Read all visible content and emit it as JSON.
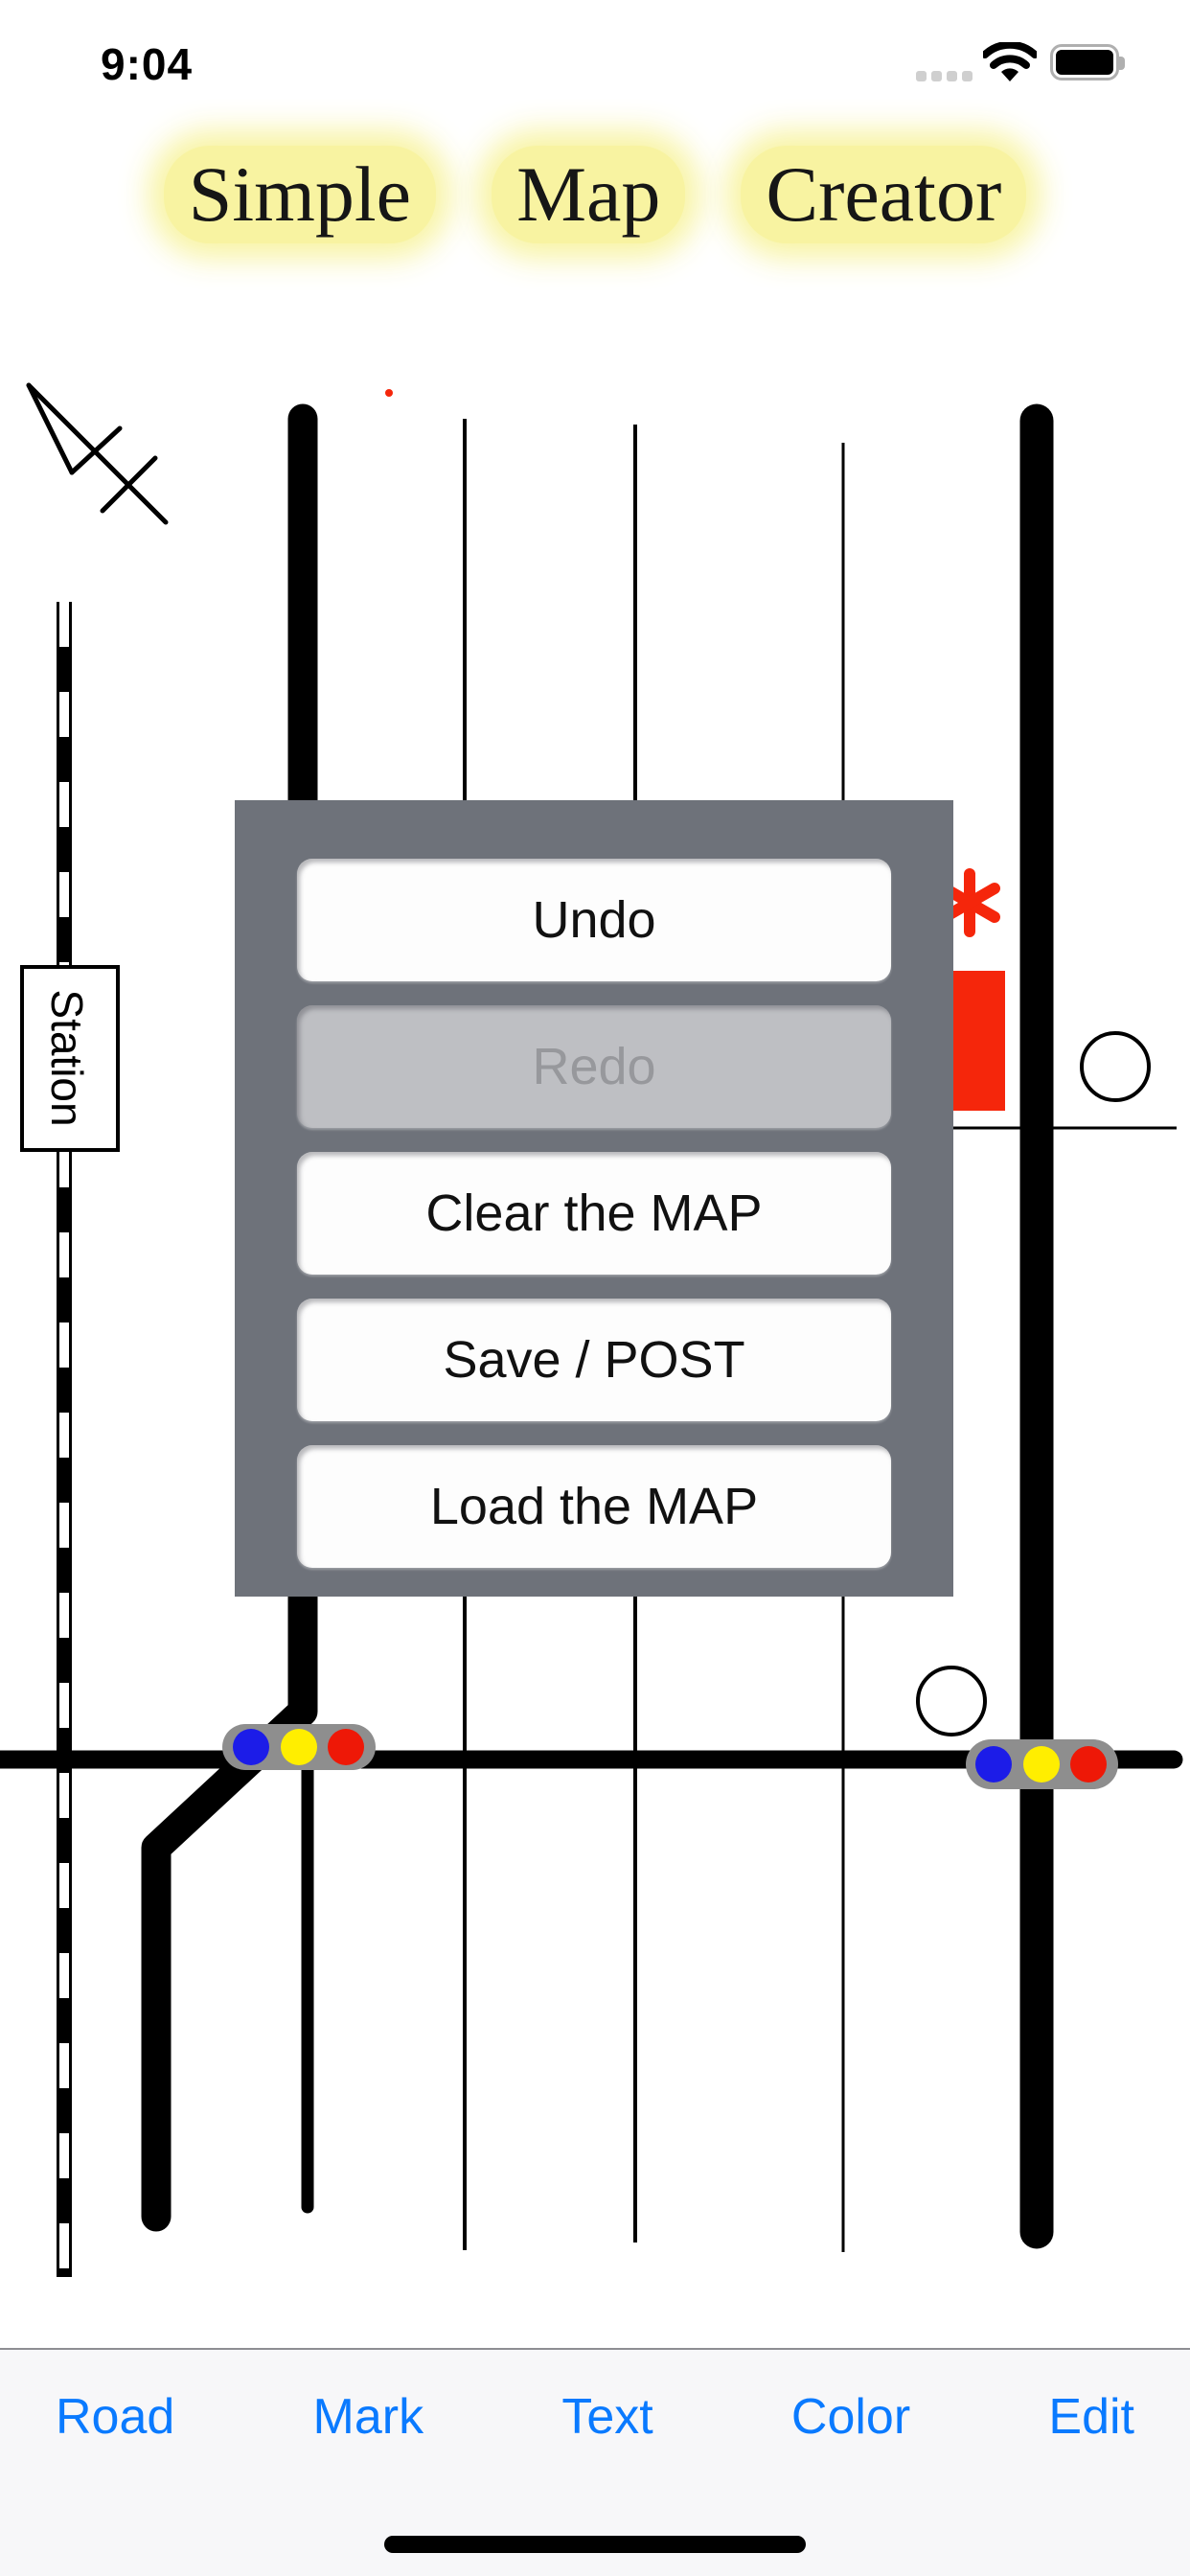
{
  "status_bar": {
    "time": "9:04",
    "battery_level": "full",
    "wifi": "connected"
  },
  "title": {
    "words": [
      "Simple",
      "Map",
      "Creator"
    ]
  },
  "map": {
    "station_label": "Station"
  },
  "popup": {
    "buttons": [
      {
        "label": "Undo",
        "enabled": true
      },
      {
        "label": "Redo",
        "enabled": false
      },
      {
        "label": "Clear the MAP",
        "enabled": true
      },
      {
        "label": "Save / POST",
        "enabled": true
      },
      {
        "label": "Load the MAP",
        "enabled": true
      }
    ]
  },
  "toolbar": {
    "items": [
      "Road",
      "Mark",
      "Text",
      "Color",
      "Edit"
    ]
  },
  "colors": {
    "ink": "#000000",
    "paper": "#ffffff",
    "popup_bg": "#6E727A",
    "button_bg": "#FDFDFD",
    "button_text": "#111111",
    "disabled_bg": "#BEBFC3",
    "disabled_text": "#97989C",
    "toolbar_bg": "#F7F7F9",
    "toolbar_border": "#8E8E93",
    "accent_blue": "#0A7AFF",
    "highlight_yellow": "#F8F3A1",
    "red": "#F5260B",
    "traffic_gray": "#8E8E8E",
    "light_blue": "#1C1CE8",
    "light_yellow": "#FFEE00",
    "light_red": "#EE1807",
    "status_gray": "#CFCFCF",
    "battery_outline": "#AFAFAF"
  }
}
